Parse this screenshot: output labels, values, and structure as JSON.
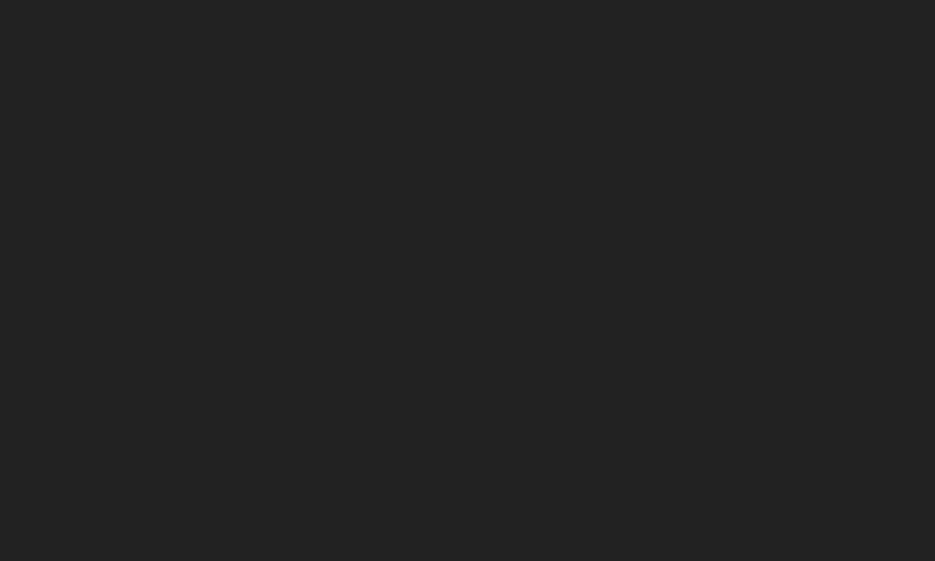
{
  "screen": {
    "background_color": "#222222"
  }
}
